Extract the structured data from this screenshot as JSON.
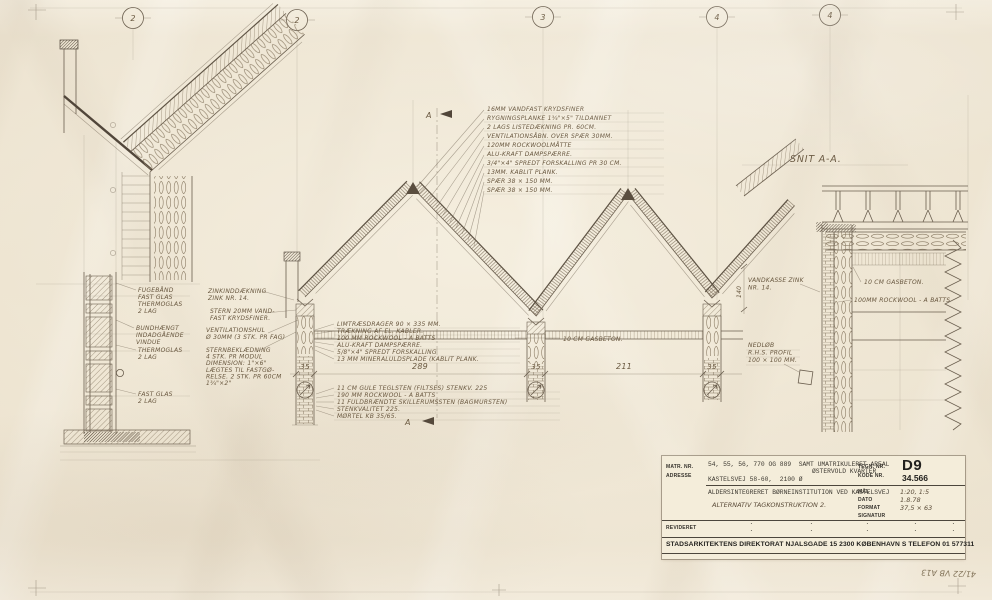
{
  "sheet": {
    "grid_bubbles": {
      "b1": "2",
      "b2": "2",
      "b3": "3",
      "b4": "4",
      "b5": "4"
    },
    "section_letter": "A",
    "snit_title": "SNIT A-A.",
    "pencil_note": "41/22 VB A13"
  },
  "dims": {
    "col": "35",
    "bay1": "289",
    "bay2": "211",
    "height_140": "140"
  },
  "annotations": {
    "roof_top": [
      "16MM VANDFAST KRYDSFINER",
      "RYGNINGSPLANKE 1¾\"×5\" TILDANNET",
      "2 LAGS LISTEDÆKNING PR. 60CM.",
      "VENTILATIONSÅBN. OVER SPÆR 30MM.",
      "120MM ROCKWOOLMÅTTE",
      "ALU-KRAFT DAMPSPÆRRE.",
      "3/4\"×4\" SPREDT FORSKALLING PR 30 CM.",
      "13MM. KABLIT PLANK.",
      "SPÆR 38 × 150 MM.",
      "SPÆR 38 × 150 MM."
    ],
    "beam": [
      "LIMTRÆSDRAGER 90 × 335 MM.",
      "TRÆKNING AF EL. KABLER.",
      "100 MM ROCKWOOL - A BATTS",
      "ALU-KRAFT DAMPSPÆRRE.",
      "5/8\"×4\" SPREDT FORSKALLING",
      "13 MM MINERALULDSPLADE (KABLIT PLANK."
    ],
    "wall": [
      "11 CM GULE TEGLSTEN (FILTSES) STENKV. 225",
      "190 MM ROCKWOOL - A BATTS",
      "11 FULDBRÆNDTE SKILLERUMSSTEN (BAGMURSTEN)",
      "STENKVALITET 225.",
      "MØRTEL KB 35/65."
    ],
    "gasbeton_mid": "10 CM GASBETON.",
    "window_1": [
      "FUGEBÅND",
      "FAST GLAS",
      "THERMOGLAS",
      "2 LAG"
    ],
    "window_2": [
      "BUNDHÆNGT",
      "INDADGÅENDE",
      "VINDUE"
    ],
    "window_3": [
      "THERMOGLAS",
      "2 LAG"
    ],
    "window_4": [
      "FAST GLAS",
      "2 LAG"
    ],
    "stern_1": [
      "ZINKINDDÆKNING",
      "ZINK NR. 14."
    ],
    "stern_2": [
      "STERN 20MM VAND-",
      "FAST KRYDSFINER."
    ],
    "stern_3": [
      "VENTILATIONSHUL",
      "Ø 30MM (3 STK. PR FAG)"
    ],
    "stern_4": [
      "STERNBEKLÆDNING",
      "4 STK. PR MODUL",
      "DIMENSION: 1\"×6\"",
      "LÆGTES TIL FASTGØ-",
      "RELSE. 2 STK. PR 60CM",
      "1¾\"×2\""
    ],
    "snit_vandkasse": [
      "VANDKASSE ZINK",
      "NR. 14."
    ],
    "snit_gasbeton": "10 CM GASBETON.",
    "snit_rockwool": "100MM ROCKWOOL - A BATTS",
    "snit_nedlob": [
      "NEDLØB",
      "R.H.S. PROFIL",
      "100 × 100 MM."
    ]
  },
  "titleblock": {
    "matr_label": "MATR. NR.",
    "adresse_label": "ADRESSE",
    "tegn_label": "TEGN. NR.",
    "kode_label": "KODE NR.",
    "matr_value": "54, 55, 56, 770 OG 889  SAMT UMATRIKULERET AREAL",
    "matr_value2": "ØSTERVOLD KVARTER",
    "adresse_value": "KASTELSVEJ 58-60,  2100 Ø",
    "tegn_value": "D9",
    "kode_value": "34.566",
    "project": "ALDERSINTEGRERET BØRNEINSTITUTION VED KASTELSVEJ",
    "subject": "ALTERNATIV TAGKONSTRUKTION 2.",
    "maal_label": "MÅL",
    "dato_label": "DATO",
    "format_label": "FORMAT",
    "signatur_label": "SIGNATUR",
    "maal_value": "1:20, 1:5",
    "dato_value": "1.8.78",
    "format_value": "37,5 × 63",
    "revideret_label": "REVIDERET",
    "revideret_dot": "·",
    "footer": "STADSARKITEKTENS DIREKTORAT   NJALSGADE 15   2300 KØBENHAVN S   TELEFON 01 577311"
  }
}
